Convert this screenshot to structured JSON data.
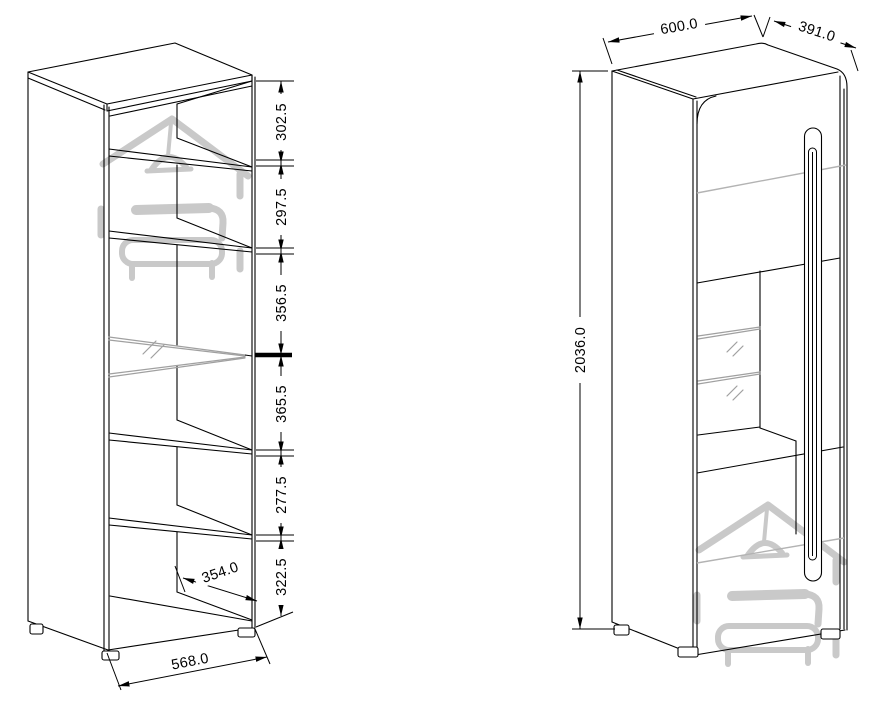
{
  "front_view": {
    "height_segments": [
      "302.5",
      "297.5",
      "356.5",
      "365.5",
      "277.5",
      "322.5"
    ],
    "interior_depth_label": "354.0",
    "width_label": "568.0"
  },
  "side_view": {
    "width_label": "600.0",
    "depth_label": "391.0",
    "height_label": "2036.0"
  },
  "colors": {
    "line": "#000000",
    "glass_line": "#a0a0a0",
    "door_accent_line": "#b3b3b3",
    "watermark": "#c9c9c9",
    "background": "#ffffff"
  }
}
